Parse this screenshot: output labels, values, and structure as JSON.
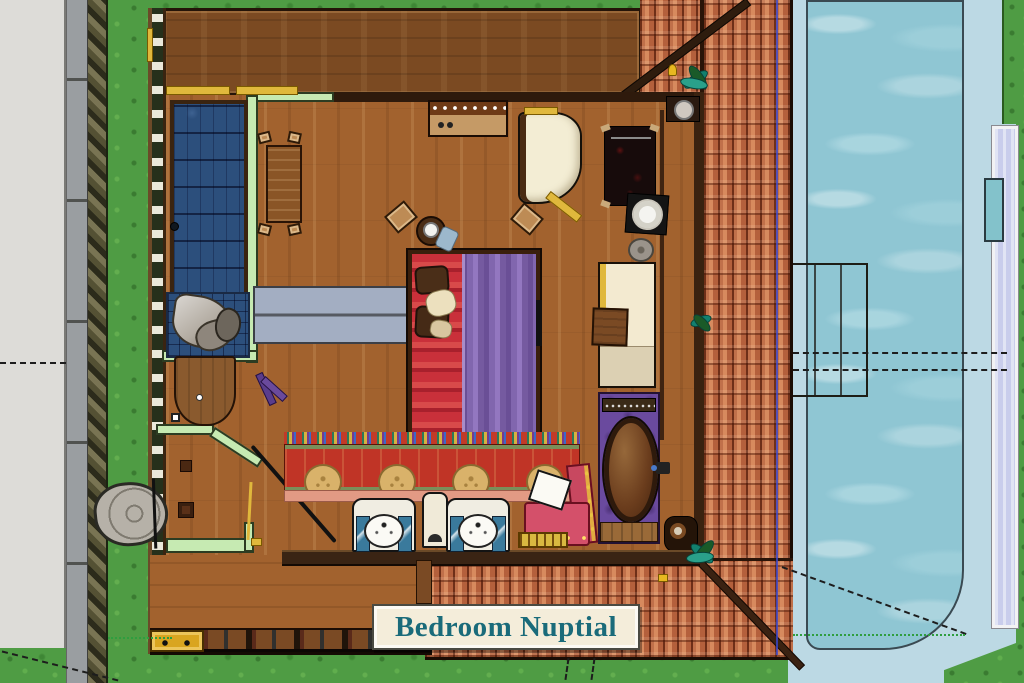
{
  "scene": {
    "type": "architectural-floor-plan-top-view",
    "room_label": "Bedroom Nuptial"
  },
  "label": {
    "text": "Bedroom Nuptial"
  },
  "colors": {
    "grass": "#4f9c44",
    "patio": "#dddcd8",
    "concrete": "#9a9ea1",
    "wood": "#a2622e",
    "roof_band": "#7b4a22",
    "tile": "#b4603c",
    "water": "#8fc6d3",
    "deck": "#bcd9e4",
    "wall_green": "#c6eab2",
    "screen_blue": "#2c4f7c",
    "bed_red": "#c9303a",
    "bed_purple": "#8166ae",
    "tub_purple": "#6a4a9e",
    "rug_red": "#c03426",
    "bench": "#a3aec2",
    "label_bg": "#f4edda",
    "label_fg": "#1a6b7a",
    "gold": "#e0b83c",
    "chair_pink": "#d4506a"
  },
  "elements": {
    "areas": [
      "patio",
      "garden-grass",
      "swimming-pool",
      "pool-deck",
      "bedroom",
      "bathroom",
      "shower",
      "roof-tiles",
      "wood-deck"
    ],
    "furniture": [
      "double-bed",
      "bench",
      "desk-with-chairs",
      "console-dresser",
      "chaise-lounge",
      "daybed",
      "bathtub",
      "twin-sinks",
      "vanity-chair",
      "runner-rug",
      "prayer-rug",
      "toilet-vanity",
      "stone-pot",
      "rock-fountain",
      "pool-bridge"
    ]
  }
}
